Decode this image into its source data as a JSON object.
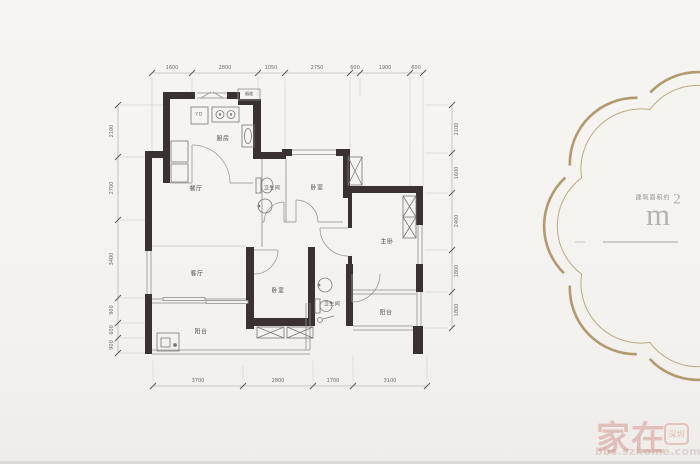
{
  "image": {
    "type": "apartment-floor-plan"
  },
  "dimensions": {
    "top": [
      "1600",
      "2800",
      "1050",
      "2750",
      "600",
      "1900",
      "600"
    ],
    "left": [
      "2100",
      "2700",
      "3400",
      "900",
      "600",
      "900"
    ],
    "right": [
      "2100",
      "1600",
      "2400",
      "1800",
      "1800"
    ],
    "bottom": [
      "3700",
      "2800",
      "1700",
      "3100"
    ]
  },
  "rooms": {
    "kitchen": "厨房",
    "dining": "餐厅",
    "living": "客厅",
    "bath1": "卫生间",
    "bath2": "卫生间",
    "bed1": "卧室",
    "bed2": "卧室",
    "master": "主卧",
    "balcony1": "阳台",
    "balcony2": "阳台",
    "flue": "烟道",
    "appliance": "YD"
  },
  "emblem": {
    "caption": "建筑面积约",
    "unit": "m",
    "sup": "2",
    "accent_color": "#a8905f"
  },
  "watermark": {
    "brand": "家在",
    "badge": "深圳",
    "site": "bbs.szhome.com",
    "color": "#c1564c"
  }
}
